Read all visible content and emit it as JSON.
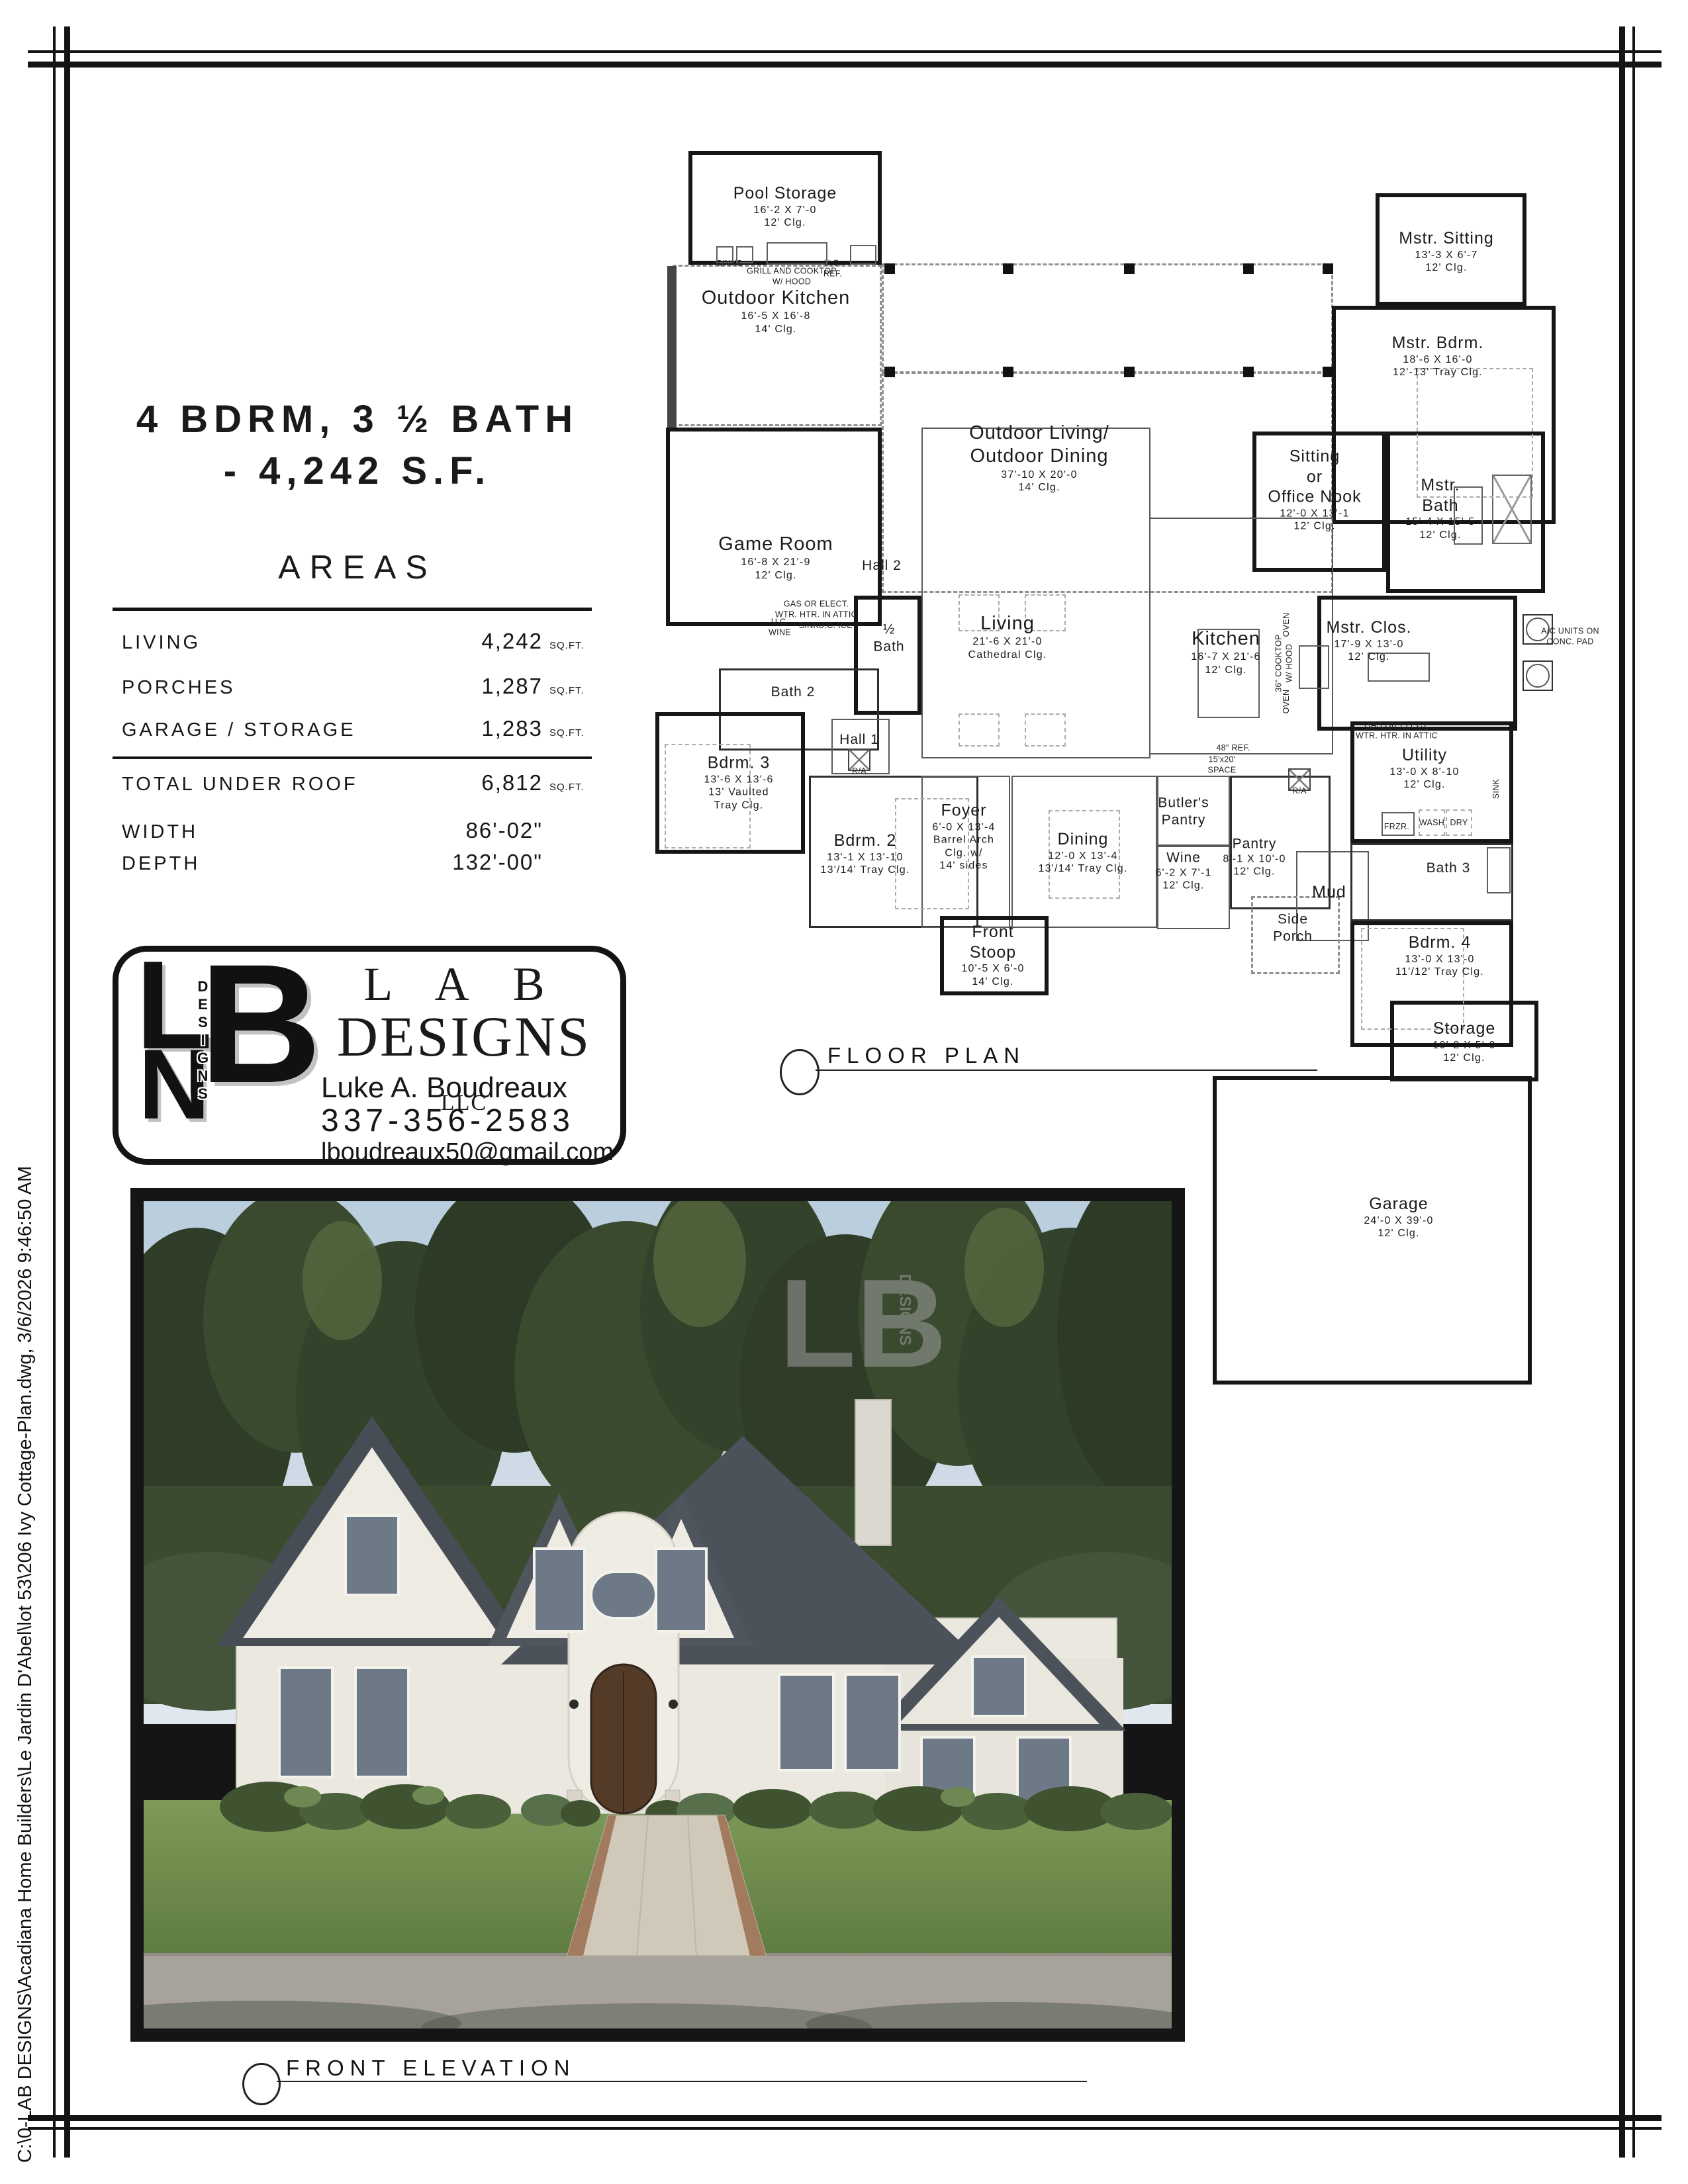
{
  "sheet": {
    "margin_note": "C:\\0-LAB DESIGNS\\Acadiana Home Builders\\Le Jardin D'Abel\\lot 53\\206 Ivy Cottage-Plan.dwg, 3/6/2026 9:46:50 AM"
  },
  "title": {
    "line1": "4 BDRM, 3 ½ BATH",
    "line2": "- 4,242 S.F."
  },
  "areas": {
    "heading": "AREAS",
    "rows": [
      {
        "label": "LIVING",
        "value": "4,242",
        "unit": "SQ.FT."
      },
      {
        "label": "PORCHES",
        "value": "1,287",
        "unit": "SQ.FT."
      },
      {
        "label": "GARAGE / STORAGE",
        "value": "1,283",
        "unit": "SQ.FT."
      }
    ],
    "total": {
      "label": "TOTAL UNDER ROOF",
      "value": "6,812",
      "unit": "SQ.FT."
    },
    "width": {
      "label": "WIDTH",
      "value": "86'-02\"",
      "unit": ""
    },
    "depth": {
      "label": "DEPTH",
      "value": "132'-00\"",
      "unit": ""
    }
  },
  "logo": {
    "mono_l": "L",
    "mono_n": "N",
    "mono_b": "B",
    "mono_vertical": "DESIGNS",
    "name_line1": "L A B",
    "name_line2": "DESIGNS",
    "llc": "LLC",
    "contact_name": "Luke A. Boudreaux",
    "phone": "337-356-2583",
    "email": "lboudreaux50@gmail.com"
  },
  "callouts": {
    "floor_plan": "FLOOR PLAN",
    "front_elevation": "FRONT ELEVATION"
  },
  "rooms": {
    "pool_storage": {
      "lines": [
        "Pool Storage",
        "16'-2 X 7'-0",
        "12' Clg."
      ]
    },
    "outdoor_kitchen": {
      "lines": [
        "Outdoor Kitchen",
        "16'-5 X 16'-8",
        "14' Clg."
      ]
    },
    "mstr_sitting": {
      "lines": [
        "Mstr. Sitting",
        "13'-3 X 6'-7",
        "12' Clg."
      ]
    },
    "mstr_bdrm": {
      "lines": [
        "Mstr. Bdrm.",
        "18'-6 X 16'-0",
        "12'-13' Tray Clg."
      ]
    },
    "outdoor_living": {
      "lines": [
        "Outdoor Living/",
        "Outdoor Dining",
        "37'-10 X 20'-0",
        "14' Clg."
      ]
    },
    "sitting_office": {
      "lines": [
        "Sitting",
        "or",
        "Office Nook",
        "12'-0 X 13'-1",
        "12' Clg."
      ]
    },
    "mstr_bath": {
      "lines": [
        "Mstr.",
        "Bath",
        "15'-4 X 15'-5",
        "12' Clg."
      ]
    },
    "game_room": {
      "lines": [
        "Game Room",
        "16'-8 X 21'-9",
        "12' Clg."
      ]
    },
    "hall2": {
      "lines": [
        "Hall 2"
      ]
    },
    "half_bath": {
      "lines": [
        "½",
        "Bath"
      ]
    },
    "living": {
      "lines": [
        "Living",
        "21'-6 X 21'-0",
        "Cathedral Clg."
      ]
    },
    "kitchen": {
      "lines": [
        "Kitchen",
        "16'-7 X 21'-6",
        "12' Clg."
      ]
    },
    "mstr_clos": {
      "lines": [
        "Mstr. Clos.",
        "17'-9 X 13'-0",
        "12' Clg."
      ]
    },
    "bath2": {
      "lines": [
        "Bath 2"
      ]
    },
    "bdrm3": {
      "lines": [
        "Bdrm. 3",
        "13'-6 X 13'-6",
        "13' Vaulted",
        "Tray Clg."
      ]
    },
    "hall1": {
      "lines": [
        "Hall 1"
      ]
    },
    "bdrm2": {
      "lines": [
        "Bdrm. 2",
        "13'-1 X 13'-10",
        "13'/14' Tray Clg."
      ]
    },
    "foyer": {
      "lines": [
        "Foyer",
        "6'-0 X 13'-4",
        "Barrel Arch",
        "Clg. w/",
        "14' sides"
      ]
    },
    "dining": {
      "lines": [
        "Dining",
        "12'-0 X 13'-4",
        "13'/14' Tray Clg."
      ]
    },
    "butlers_pantry": {
      "lines": [
        "Butler's",
        "Pantry"
      ]
    },
    "wine": {
      "lines": [
        "Wine",
        "6'-2 X 7'-1",
        "12' Clg."
      ]
    },
    "pantry": {
      "lines": [
        "Pantry",
        "8'-1 X 10'-0",
        "12' Clg."
      ]
    },
    "mud": {
      "lines": [
        "Mud"
      ]
    },
    "side_porch": {
      "lines": [
        "Side",
        "Porch"
      ]
    },
    "utility": {
      "lines": [
        "Utility",
        "13'-0 X 8'-10",
        "12' Clg."
      ]
    },
    "bath3": {
      "lines": [
        "Bath 3"
      ]
    },
    "bdrm4": {
      "lines": [
        "Bdrm. 4",
        "13'-0 X 13'-0",
        "11'/12' Tray Clg."
      ]
    },
    "storage": {
      "lines": [
        "Storage",
        "10'-2 X 5'-0",
        "12' Clg."
      ]
    },
    "front_stoop": {
      "lines": [
        "Front",
        "Stoop",
        "10'-5 X 6'-0",
        "14' Clg."
      ]
    },
    "garage": {
      "lines": [
        "Garage",
        "24'-0 X 39'-0",
        "12' Clg."
      ]
    }
  },
  "annotations": {
    "sinks": "SINKS",
    "grill": "GRILL AND COOKTOP\nW/ HOOD",
    "uc_ref": "U.C.\nREF.",
    "wtr_htr_1": "GAS OR ELECT.\nWTR. HTR. IN ATTIC",
    "uc_wine": "U.C.\nWINE",
    "bar_sink": "SINK",
    "uc_ice": "U.C. ICE",
    "oven1": "OVEN",
    "cooktop": "36\" COOKTOP\nW/ HOOD",
    "oven2": "OVEN",
    "ref48": "48\" REF.",
    "space": "15'x20'\nSPACE",
    "wtr_htr_2": "GAS OR ELECT.\nWTR. HTR. IN ATTIC",
    "ra1": "R/A",
    "ra2": "R/A",
    "frzr": "FRZR.",
    "wash": "WASH",
    "dry": "DRY",
    "utility_sink": "SINK",
    "ac_units": "A/C UNITS ON\nCONC. PAD"
  },
  "photo": {
    "watermark_monogram": "LB",
    "watermark_word": "DESIGNS"
  }
}
